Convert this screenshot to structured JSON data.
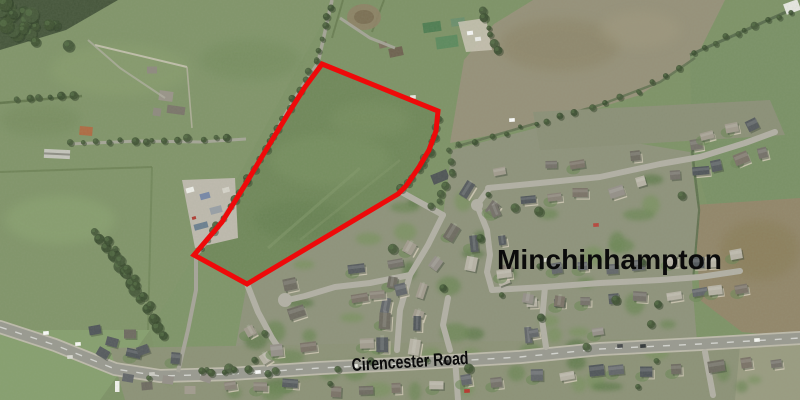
{
  "labels": {
    "place": "Minchinhampton",
    "road": "Cirencester Road"
  },
  "annotation": {
    "site_boundary_color": "#ee0a0a",
    "site_boundary_width": 5,
    "site_boundary_points": "322,64 438,111 436,131 429,150 419,167 406,186 398,194 247,284 194,255 222,222 245,185 266,150 288,114 305,87",
    "label_color": "#0b0b0b"
  }
}
